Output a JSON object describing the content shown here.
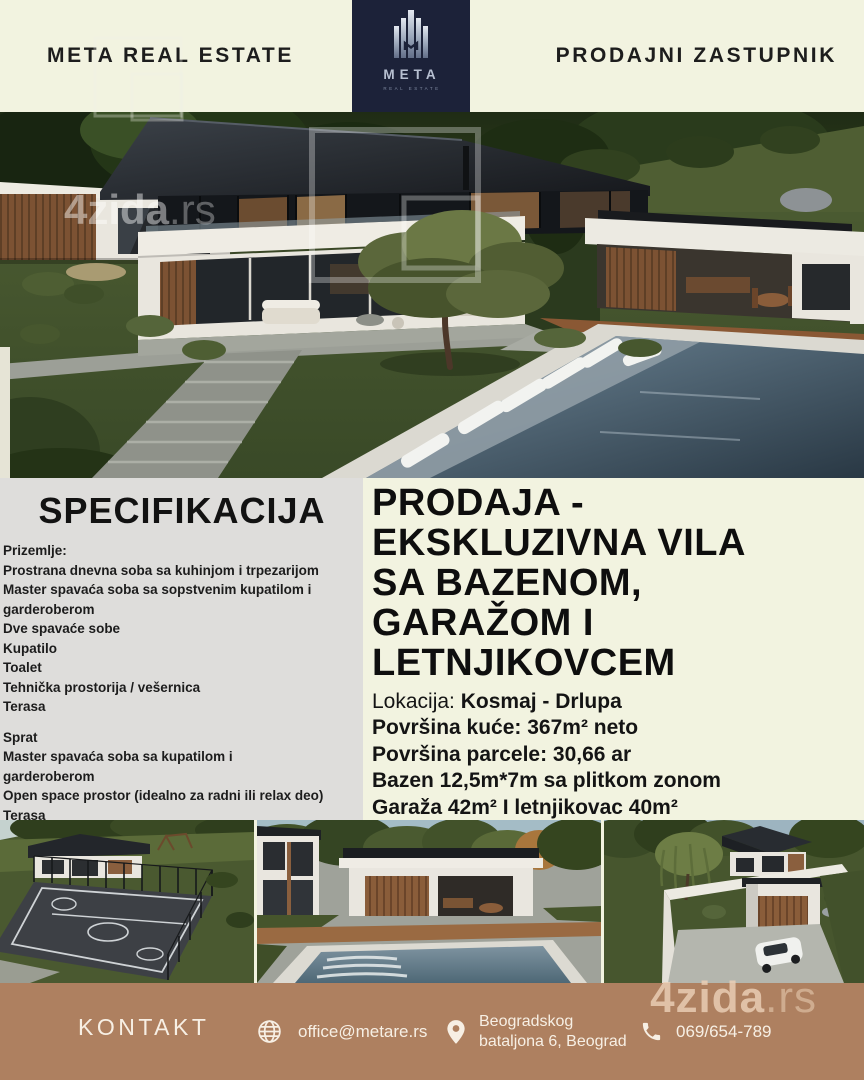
{
  "header": {
    "agency_name": "META REAL ESTATE",
    "role_label": "PRODAJNI ZASTUPNIK",
    "logo_brand": "META",
    "logo_subtext": "REAL ESTATE"
  },
  "hero": {
    "watermark_bold": "4zida",
    "watermark_light": ".rs"
  },
  "specifications": {
    "title": "SPECIFIKACIJA",
    "ground_floor": [
      "Prizemlje:",
      "Prostrana dnevna soba sa kuhinjom i trpezarijom",
      "Master spavaća soba sa sopstvenim kupatilom i\ngarderoberom",
      "Dve spavaće sobe",
      "Kupatilo",
      "Toalet",
      "Tehnička prostorija / vešernica",
      "Terasa"
    ],
    "upper_floor": [
      "Sprat",
      "Master spavaća soba sa kupatilom i\ngarderoberom",
      "Open space prostor (idealno za radni ili relax deo)",
      "Terasa"
    ]
  },
  "listing": {
    "title": "PRODAJA -\nEKSKLUZIVNA VILA\nSA BAZENOM,\nGARAŽOM I\nLETNJIKOVCEM",
    "details": [
      {
        "label": "Lokacija: ",
        "value": "Kosmaj - Drlupa"
      },
      {
        "label": "",
        "value": "Površina kuće: 367m² neto"
      },
      {
        "label": "",
        "value": "Površina parcele: 30,66 ar"
      },
      {
        "label": "",
        "value": "Bazen 12,5m*7m sa plitkom zonom"
      },
      {
        "label": "",
        "value": "Garaža 42m² I letnjikovac 40m²"
      }
    ]
  },
  "footer": {
    "contact_label": "KONTAKT",
    "email": "office@metare.rs",
    "address_line1": "Beogradskog",
    "address_line2": "bataljona 6, Beograd",
    "phone": "069/654-789",
    "watermark_bold": "4zida",
    "watermark_light": ".rs"
  },
  "colors": {
    "cream": "#f2f3e0",
    "navy": "#1c2239",
    "panel_gray": "#dedddb",
    "text_dark": "#161616",
    "footer_brown": "#ae8060",
    "footer_text": "#f7efe4"
  }
}
